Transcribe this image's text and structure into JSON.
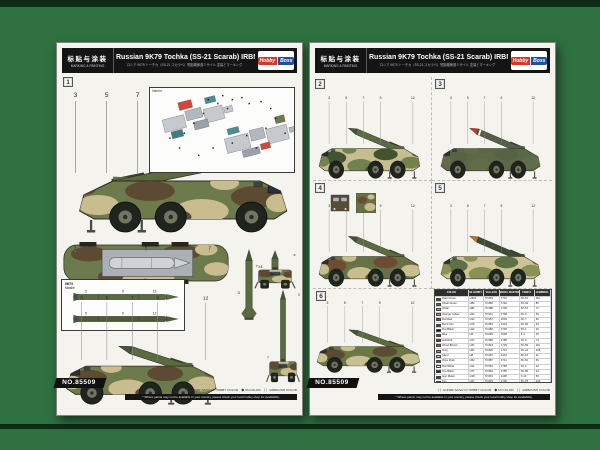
{
  "header": {
    "cn": "标贴与涂装",
    "en": "MARKING & PAINTING",
    "title": "Russian 9K79 Tochka (SS-21 Scarab) IRBM",
    "subtitle": "ロシア 9K79 トーチカ（SS-21 スカラベ）短距離弾道ミサイル  塗装とマーキング",
    "logo1": "Hobby",
    "logo2": "Boss"
  },
  "footer": {
    "kit_no": "NO.85509",
    "legend": "（ ）GUNZE SANGYO HOBBY COLOR　◆ Mr.COLOR　（ ）AIRBRUSH COLOR",
    "note": "* Where paints may not be available in your country, please check your local hobby shop for availability."
  },
  "left": {
    "inset_label": "Interior",
    "missile_label_1": "9M79",
    "missile_label_2": "Missile"
  },
  "art": {
    "callouts": [
      "3",
      "5",
      "7",
      "9",
      "12",
      "14"
    ],
    "schemes": [
      {
        "badge": "1",
        "base": "#6d7a4c",
        "p1": "#5d4a32",
        "p2": "#c9bd8f",
        "missile": "#5b6a41",
        "tip": "#46543a"
      },
      {
        "badge": "2",
        "base": "#c6bd90",
        "p1": "#43532f",
        "p2": "#73814e",
        "missile": "#5b6a41",
        "tip": "#46543a"
      },
      {
        "badge": "3",
        "base": "#5c6847",
        "p1": "#576343",
        "p2": "#616d4a",
        "missile": "#55604a",
        "tip": "#c23a26",
        "band": "#ffffff"
      },
      {
        "badge": "4",
        "base": "#667246",
        "p1": "#6e4c33",
        "p2": "#c7bd8d",
        "missile": "#5b6a41",
        "tip": "#46543a"
      },
      {
        "badge": "5",
        "base": "#cdc396",
        "p1": "#5f7046",
        "p2": "#8a9157",
        "missile": "#3e4c35",
        "tip": "#cc6c20"
      },
      {
        "badge": "6",
        "base": "#6b7747",
        "p1": "#5d4a32",
        "p2": "#c9bf90",
        "missile": "#5b6a41",
        "tip": "#46543a"
      }
    ]
  },
  "paint_table": {
    "headers": [
      "COLOR",
      "Mr.HOBBY",
      "VALLEJO",
      "MODEL MASTER",
      "TAMIYA",
      "HUMBROL"
    ],
    "rows": [
      [
        "#3c5337",
        "Dark Green",
        "H303",
        "70.893",
        "1710",
        "XF-61",
        "116"
      ],
      [
        "#5c6644",
        "Khaki Green",
        "H80",
        "70.880",
        "1702",
        "XF-49",
        "86"
      ],
      [
        "#b4a575",
        "Khaki",
        "H81",
        "70.988",
        "1709",
        "XF-57",
        "72"
      ],
      [
        "#d79a2e",
        "Orange Yellow",
        "H24",
        "70.911",
        "1708",
        "XF-3",
        "69"
      ],
      [
        "#bf3126",
        "Flat Red",
        "H13",
        "70.957",
        "1503",
        "XF-7",
        "60"
      ],
      [
        "#463f45",
        "Burnt Iron",
        "H76",
        "70.863",
        "1423",
        "XF-84",
        "53"
      ],
      [
        "#161616",
        "Flat Black",
        "H12",
        "70.950",
        "1749",
        "XF-1",
        "33"
      ],
      [
        "#2b4e93",
        "Blue",
        "H5",
        "70.839",
        "1508",
        "X-4",
        "25"
      ],
      [
        "#7a3526",
        "Hull Red",
        "H17",
        "70.985",
        "1785",
        "XF-9",
        "73"
      ],
      [
        "#96603a",
        "Wood Brown",
        "H37",
        "70.834",
        "1735",
        "XF-59",
        "110"
      ],
      [
        "#8e9494",
        "Gray",
        "H61",
        "70.836",
        "1721",
        "XF-24",
        "106"
      ],
      [
        "#c0c4c8",
        "Silver",
        "H8",
        "70.997",
        "1401",
        "XF-16",
        "11"
      ],
      [
        "#4f5a38",
        "Olive Drab",
        "H52",
        "70.887",
        "1711",
        "XF-62",
        "66"
      ],
      [
        "#f2f2ee",
        "Flat White",
        "H11",
        "70.951",
        "1768",
        "XF-2",
        "34"
      ],
      [
        "#24262a",
        "Tire Black",
        "H77",
        "70.862",
        "1755",
        "XF-85",
        "32"
      ],
      [
        "#3d4146",
        "Gun Metal",
        "H18",
        "70.801",
        "1405",
        "X-10",
        "53"
      ],
      [
        "#c9a876",
        "Tan",
        "H27",
        "70.819",
        "1706",
        "XF-78",
        "103"
      ]
    ]
  }
}
